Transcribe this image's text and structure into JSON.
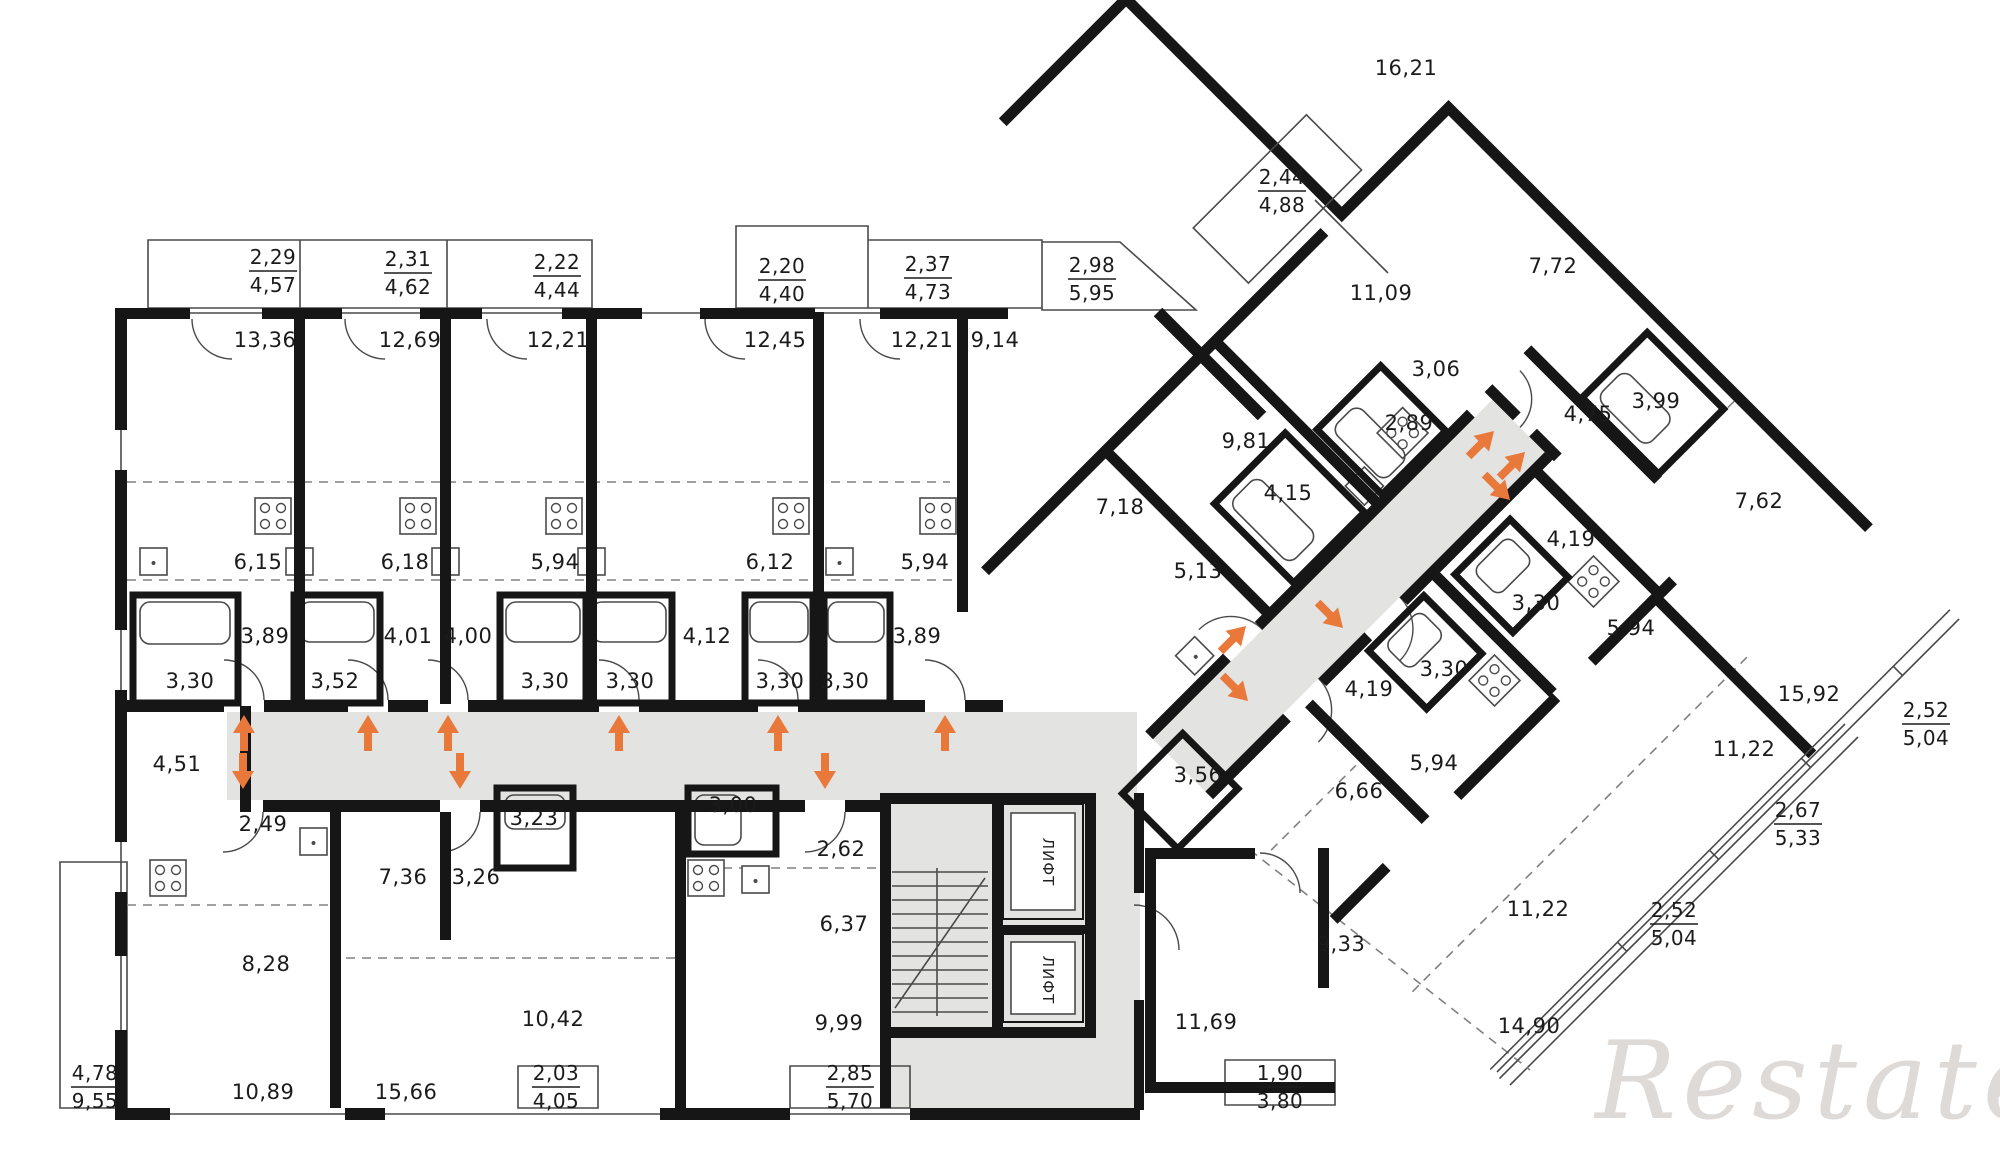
{
  "watermark": "Restate",
  "elevators": [
    "ЛИФТ",
    "ЛИФТ"
  ],
  "colors": {
    "wall": "#161616",
    "corridor_fill": "#e3e3e1",
    "arrow": "#e8793b",
    "thin_line": "#4a4a4a",
    "dashed_line": "#808080",
    "label": "#1b1b1b",
    "watermark": "#c9c2bf"
  },
  "rooms": [
    {
      "v": "13,36"
    },
    {
      "v": "12,69"
    },
    {
      "v": "12,21"
    },
    {
      "v": "12,45"
    },
    {
      "v": "12,21"
    },
    {
      "v": "9,14"
    },
    {
      "v": "6,15"
    },
    {
      "v": "6,18"
    },
    {
      "v": "5,94"
    },
    {
      "v": "6,12"
    },
    {
      "v": "5,94"
    },
    {
      "v": "3,89"
    },
    {
      "v": "4,01"
    },
    {
      "v": "4,00"
    },
    {
      "v": "4,12"
    },
    {
      "v": "3,89"
    },
    {
      "v": "3,30"
    },
    {
      "v": "3,52"
    },
    {
      "v": "3,30"
    },
    {
      "v": "3,30"
    },
    {
      "v": "3,30"
    },
    {
      "v": "3,30"
    },
    {
      "v": "4,51"
    },
    {
      "v": "2,49"
    },
    {
      "v": "7,36"
    },
    {
      "v": "3,26"
    },
    {
      "v": "3,23"
    },
    {
      "v": "8,28"
    },
    {
      "v": "10,42"
    },
    {
      "v": "10,89"
    },
    {
      "v": "15,66"
    },
    {
      "v": "3,00"
    },
    {
      "v": "2,62"
    },
    {
      "v": "6,37"
    },
    {
      "v": "9,99"
    },
    {
      "v": "7,18"
    },
    {
      "v": "5,13"
    },
    {
      "v": "9,81"
    },
    {
      "v": "4,15"
    },
    {
      "v": "2,89"
    },
    {
      "v": "3,06"
    },
    {
      "v": "11,09"
    },
    {
      "v": "16,21"
    },
    {
      "v": "7,72"
    },
    {
      "v": "4,75"
    },
    {
      "v": "3,99"
    },
    {
      "v": "7,62"
    },
    {
      "v": "4,19"
    },
    {
      "v": "3,30"
    },
    {
      "v": "5,94"
    },
    {
      "v": "3,30"
    },
    {
      "v": "4,19"
    },
    {
      "v": "5,94"
    },
    {
      "v": "6,66"
    },
    {
      "v": "15,92"
    },
    {
      "v": "11,22"
    },
    {
      "v": "11,22"
    },
    {
      "v": "9,33"
    },
    {
      "v": "3,56"
    },
    {
      "v": "11,69"
    },
    {
      "v": "14,90"
    }
  ],
  "fractions": [
    {
      "t": "2,29",
      "b": "4,57"
    },
    {
      "t": "2,31",
      "b": "4,62"
    },
    {
      "t": "2,22",
      "b": "4,44"
    },
    {
      "t": "2,20",
      "b": "4,40"
    },
    {
      "t": "2,37",
      "b": "4,73"
    },
    {
      "t": "2,98",
      "b": "5,95"
    },
    {
      "t": "2,44",
      "b": "4,88"
    },
    {
      "t": "4,78",
      "b": "9,55"
    },
    {
      "t": "2,03",
      "b": "4,05"
    },
    {
      "t": "2,85",
      "b": "5,70"
    },
    {
      "t": "1,90",
      "b": "3,80"
    },
    {
      "t": "2,52",
      "b": "5,04"
    },
    {
      "t": "2,67",
      "b": "5,33"
    },
    {
      "t": "2,52",
      "b": "5,04"
    }
  ]
}
